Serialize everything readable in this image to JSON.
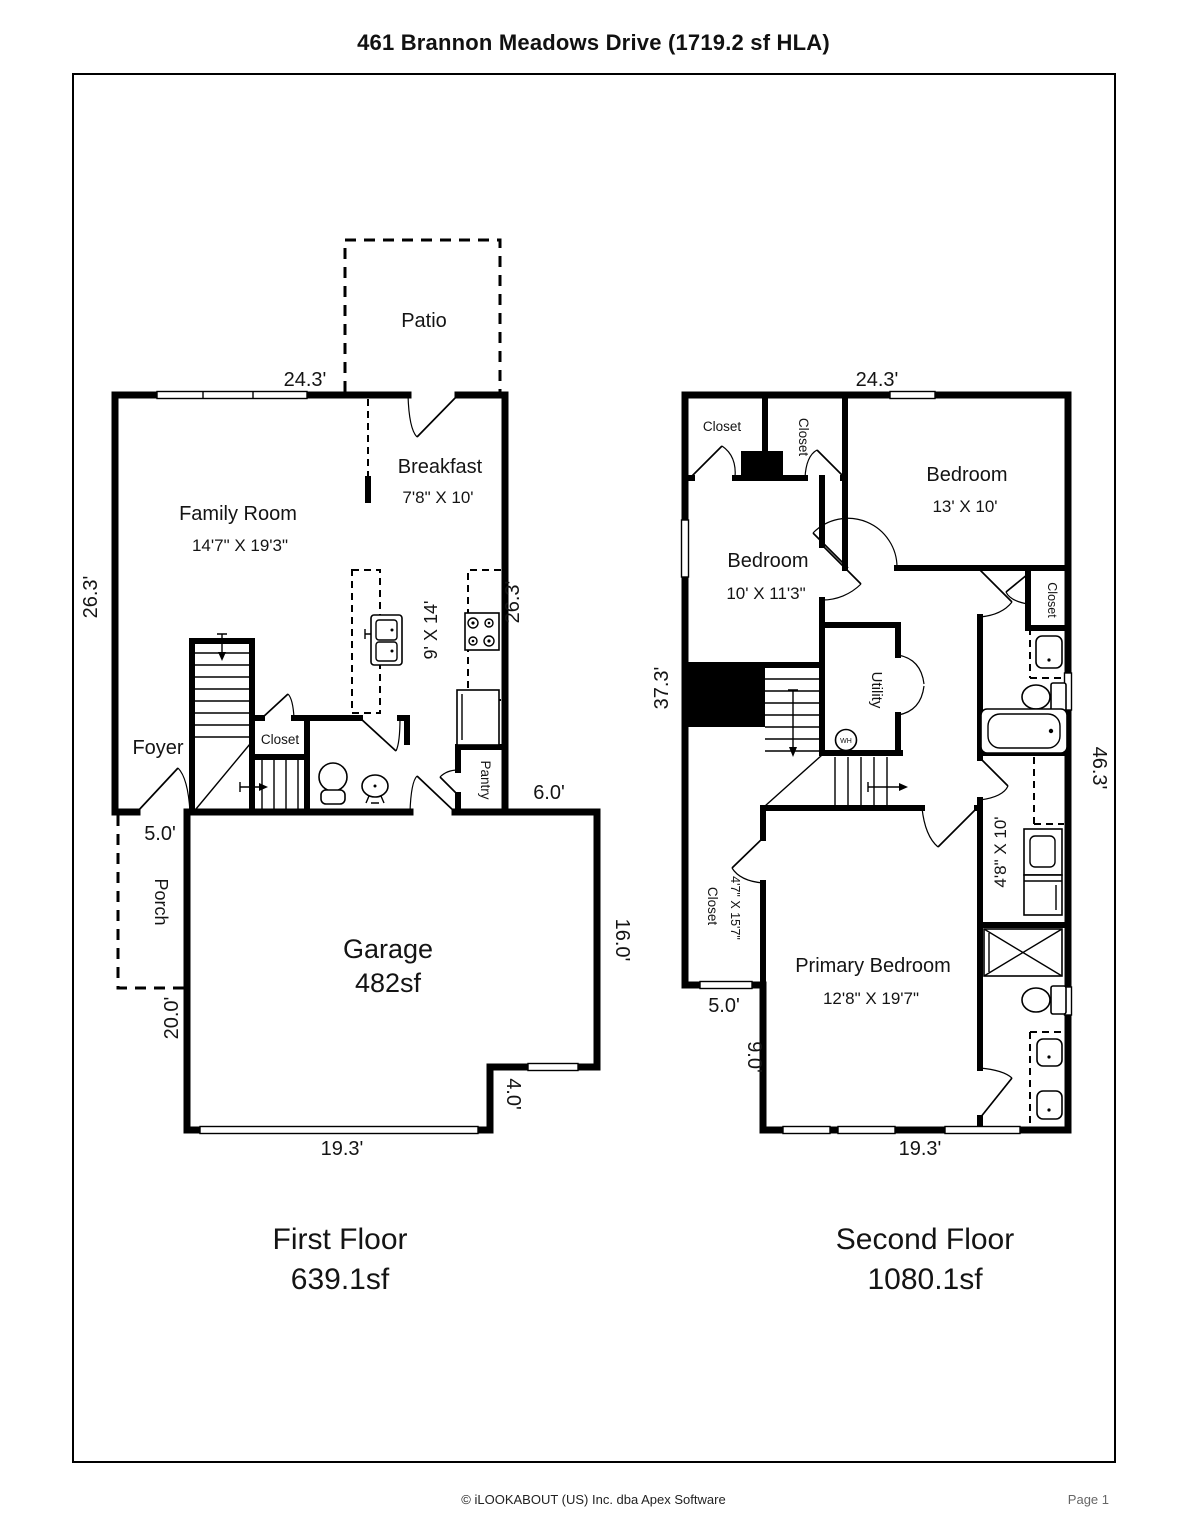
{
  "page": {
    "title": "461 Brannon Meadows Drive (1719.2 sf HLA)",
    "footer": {
      "copyright": "© iLOOKABOUT (US) Inc. dba Apex Software",
      "page": "Page 1"
    }
  },
  "first_floor": {
    "caption": "First Floor",
    "caption_area": "639.1sf",
    "rooms": {
      "patio": "Patio",
      "family_room": "Family Room",
      "family_room_dims": "14'7\" X 19'3\"",
      "breakfast": "Breakfast",
      "breakfast_dims": "7'8\" X 10'",
      "kitchen_dims": "9' X 14'",
      "foyer": "Foyer",
      "closet": "Closet",
      "pantry": "Pantry",
      "porch": "Porch",
      "garage": "Garage",
      "garage_area": "482sf"
    },
    "dims": {
      "top": "24.3'",
      "left": "26.3'",
      "right": "26.3'",
      "entry": "5.0'",
      "kitchen_side": "6.0'",
      "porch_side": "20.0'",
      "garage_right": "16.0'",
      "garage_jog": "4.0'",
      "garage_bottom": "19.3'"
    }
  },
  "second_floor": {
    "caption": "Second Floor",
    "caption_area": "1080.1sf",
    "rooms": {
      "closet_a": "Closet",
      "closet_b": "Closet",
      "bedroom_right": "Bedroom",
      "bedroom_right_dims": "13' X 10'",
      "bedroom_left": "Bedroom",
      "bedroom_left_dims": "10' X 11'3\"",
      "hall_closet": "Closet",
      "utility": "Utility",
      "water_heater": "WH",
      "long_closet": "Closet",
      "long_closet_dims": "4'7\" X 15'7\"",
      "bath_dims": "4'8\" X 10'",
      "primary_bedroom": "Primary Bedroom",
      "primary_bedroom_dims": "12'8\" X 19'7\""
    },
    "dims": {
      "top": "24.3'",
      "upper_left": "37.3'",
      "right": "46.3'",
      "bottom_left": "5.0'",
      "lower_left": "9.0'",
      "bottom": "19.3'"
    }
  }
}
